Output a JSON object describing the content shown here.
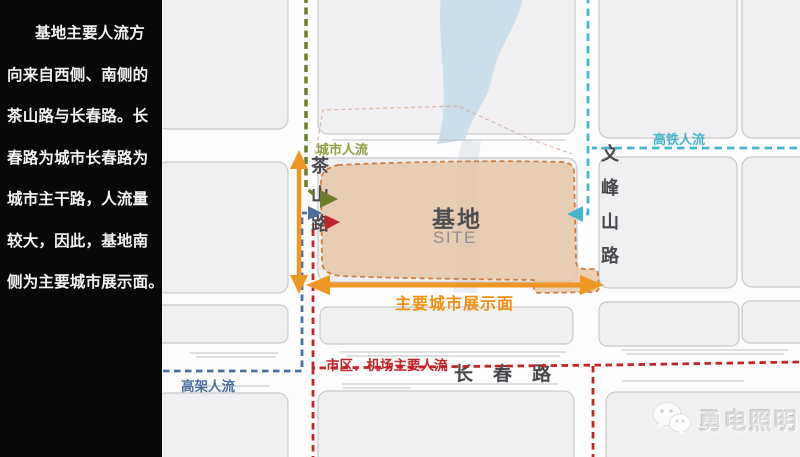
{
  "sidebar": {
    "lines": [
      "基地主要人流方",
      "向来自西侧、南侧的",
      "茶山路与长春路。长",
      "春路为城市长春路为",
      "城市主干路，人流量",
      "较大，因此，基地南",
      "侧为主要城市展示面。"
    ]
  },
  "map": {
    "site": {
      "label": "基地",
      "sublabel": "SITE"
    },
    "roads": {
      "chashan": "茶山路",
      "wenfeng": "文峰山路",
      "changchun": "长春路"
    },
    "flows": {
      "city": {
        "label": "城市人流",
        "color": "#8f9c3f"
      },
      "rail": {
        "label": "高铁人流",
        "color": "#44b7cc"
      },
      "elevated": {
        "label": "高架人流",
        "color": "#4a6f9e"
      },
      "urban_airport": {
        "label": "市区、机场主要人流",
        "color": "#c3242a"
      },
      "display_front": {
        "label": "主要城市展示面",
        "color": "#ef8f13"
      }
    },
    "site_colors": {
      "fill": "#e6c4a4",
      "border": "#cf8040"
    }
  },
  "watermark": {
    "icon": "wechat-icon",
    "text": "勇电照明"
  }
}
